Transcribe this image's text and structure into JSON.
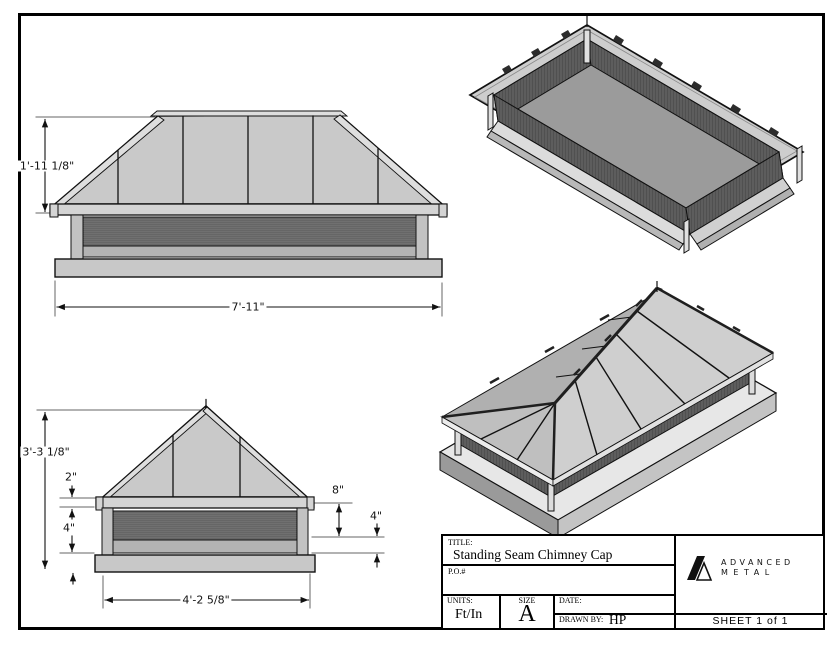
{
  "views": {
    "front": {
      "height_dim": "1'-11 1/8\"",
      "width_dim": "7'-11\""
    },
    "side": {
      "height_dim": "3'-3 1/8\"",
      "fascia_dim": "2\"",
      "skirt_dim": "4\"",
      "roof_drop_dim": "8\"",
      "base_dim": "4\"",
      "width_dim": "4'-2 5/8\""
    }
  },
  "title_block": {
    "title_label": "TITLE:",
    "title": "Standing Seam Chimney Cap",
    "po_label": "P.O.#",
    "units_label": "UNITS:",
    "units_value": "Ft/In",
    "size_label": "SIZE",
    "size_value": "A",
    "date_label": "DATE:",
    "drawn_by_label": "DRAWN BY:",
    "drawn_by_value": "HP",
    "sheet_label": "SHEET 1 of 1",
    "logo_line1": "ADVANCED",
    "logo_line2": "METAL"
  },
  "colors": {
    "line": "#111111",
    "roof": "#c9c9c9",
    "fascia": "#d4d4d4",
    "mesh": "#666666",
    "base": "#c8c8c8",
    "background": "#ffffff"
  }
}
